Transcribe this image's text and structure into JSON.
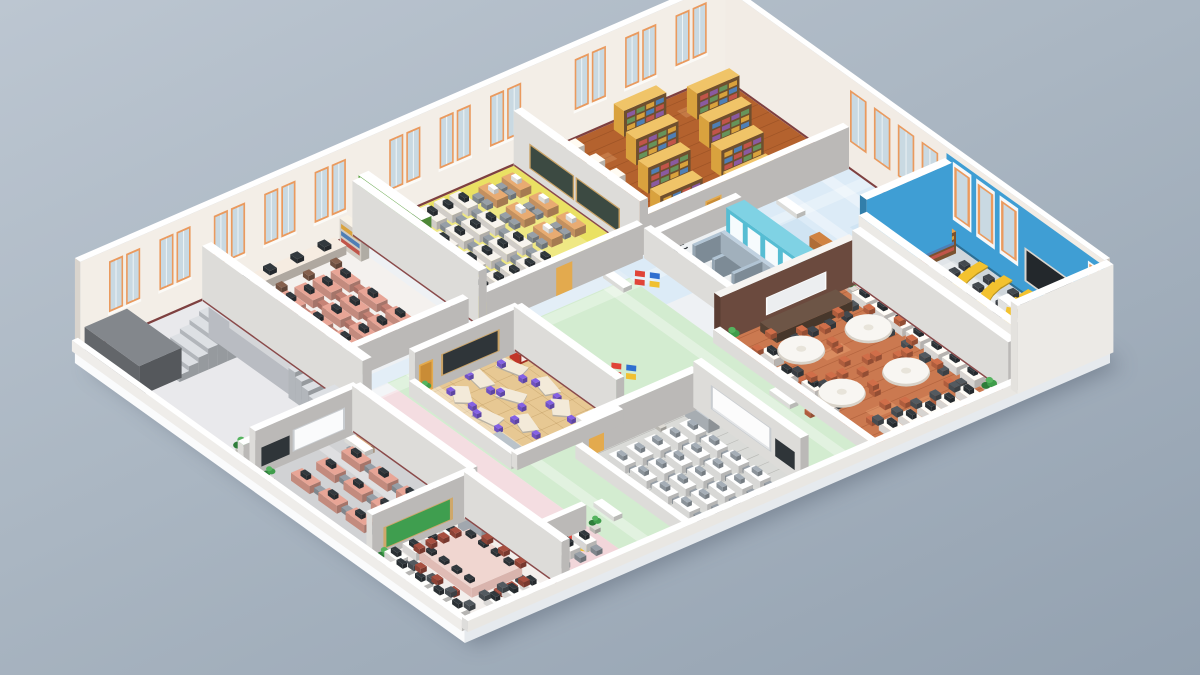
{
  "scene": {
    "title": "Isometric cutaway floor plan of a school building",
    "description": "3D rendered isometric floor plan with library, classrooms, offices, lecture room, banquet room, WC and lobby"
  },
  "labels": {
    "wc": "WC"
  },
  "palette": {
    "background_top": "#bcc6d1",
    "background_bottom": "#93a1b0",
    "slab": "#eef1f4",
    "wall_face": "#f1ebe4",
    "wall_white": "#f6f4f1",
    "baseboard": "#7e4040",
    "window_frame": "#ea9a5e",
    "window_glass": "#c9d9e2",
    "corridor_floor": "#dcebf7",
    "green_corridor": "#d3ecd0",
    "pink_corridor": "#f4dde1",
    "accent_green_wall": "#6fc24f",
    "blue_wall": "#3f9ed4",
    "chalkboard": "#3c4a42",
    "blackboard": "#23282c",
    "board_dark": "#2f3539",
    "whiteboard": "#fafbfc",
    "mosaic_red": "#e04438",
    "mosaic_blue": "#2f6fd0",
    "mosaic_yellow": "#f0c030",
    "plant_green": "#3f9d4b",
    "locker_gray": "#aeb6bd",
    "stair_gray": "#c6cad0",
    "elevator_gray": "#6a6e72",
    "bookshelf_wood": "#e8b64d",
    "desk_yellow": "#f3c22f",
    "desk_salmon": "#d99a8c",
    "desk_wood": "#d9a06b",
    "chair_dark": "#4e545a",
    "chair_gray": "#8d959c",
    "chair_terracotta": "#c26744",
    "chair_red": "#9c4a3c",
    "table_pink": "#edcdc6",
    "kid_purple": "#7b5bd6",
    "cubby_red": "#d63c2e"
  },
  "rooms": [
    {
      "id": "library",
      "name": "Library",
      "floor_color": "#b4622e",
      "furniture": "bookshelves, reading tables"
    },
    {
      "id": "computer_lab",
      "name": "Computer Lab",
      "floor_color": "#eae163",
      "furniture": "monitor desk rows, wood desks, green accent wall"
    },
    {
      "id": "staff_office",
      "name": "Staff Office",
      "floor_color": "#f4f1ee",
      "furniture": "salmon desks, window counter"
    },
    {
      "id": "lobby",
      "name": "Lobby / Stairwell",
      "floor_color": "#e9e9ec",
      "furniture": "double staircase, elevator block"
    },
    {
      "id": "main_hall",
      "name": "Main Hall & Corridor",
      "floor_color": "#dcebf7",
      "furniture": "benches, mosaic floor medallions"
    },
    {
      "id": "lecture_room",
      "name": "Lecture Room",
      "floor_color": "#cfd6db",
      "furniture": "curved yellow desk rows, chalkboard"
    },
    {
      "id": "wc",
      "name": "WC",
      "floor_color": "#eef1f3",
      "furniture": "cyan stalls, toilet partitions"
    },
    {
      "id": "banquet_room",
      "name": "Seminar / Banquet Room",
      "floor_color": "#cb7950",
      "furniture": "round tables, head table, computer desks"
    },
    {
      "id": "kids_classroom",
      "name": "Kindergarten Classroom",
      "floor_color": "#e7c893",
      "furniture": "angled tables, red cubbies, lockers"
    },
    {
      "id": "training_room",
      "name": "Training Room",
      "floor_color": "#dadbd8",
      "furniture": "white desk rows, projection screen"
    },
    {
      "id": "pink_classroom",
      "name": "Computer Classroom",
      "floor_color": "#d1d2d4",
      "furniture": "pink desks, green chalkboard, screen"
    },
    {
      "id": "conference_room",
      "name": "Conference Room",
      "floor_color": "#f3efec",
      "furniture": "large meeting table, perimeter desks"
    }
  ]
}
